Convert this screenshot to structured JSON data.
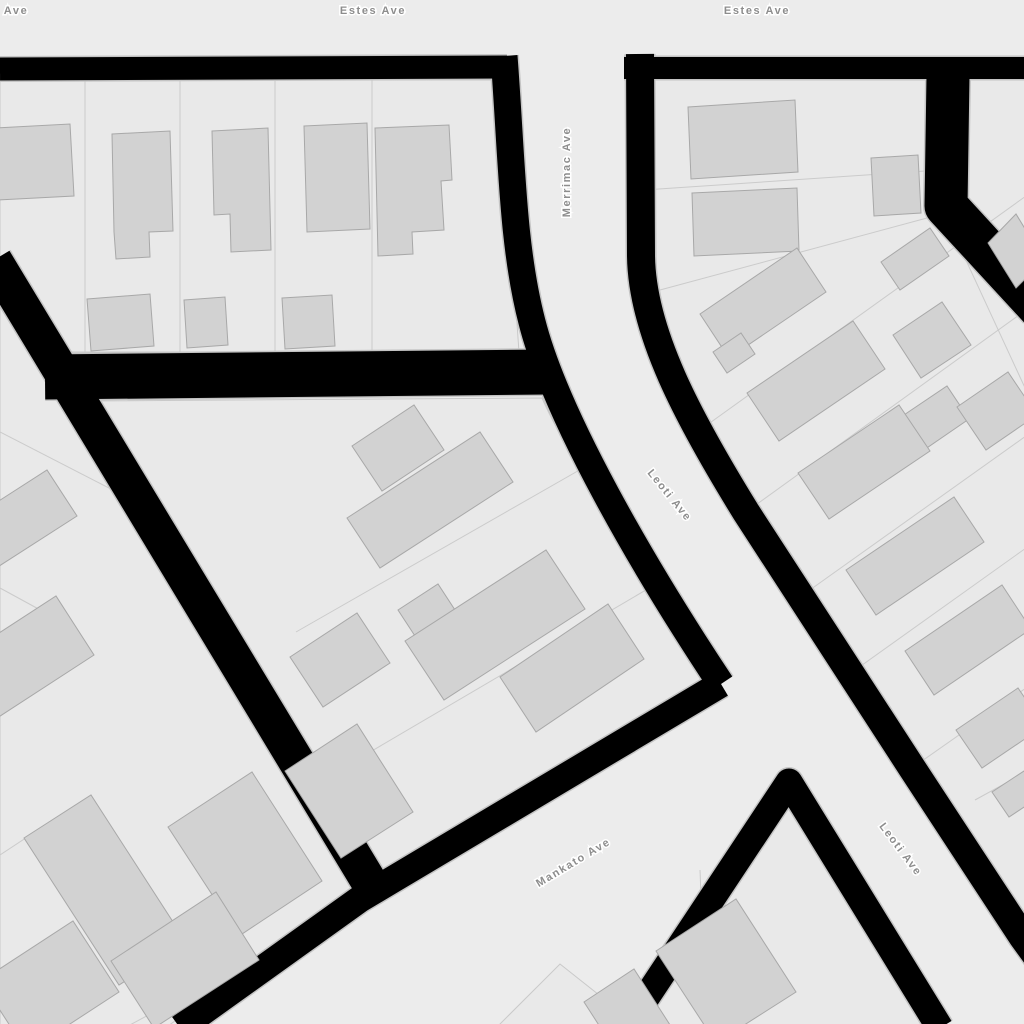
{
  "map": {
    "street_labels": [
      {
        "text": "Ave",
        "x": 16,
        "y": 10,
        "rotation": 0
      },
      {
        "text": "Estes Ave",
        "x": 373,
        "y": 10,
        "rotation": 0
      },
      {
        "text": "Estes Ave",
        "x": 757,
        "y": 10,
        "rotation": 0
      },
      {
        "text": "Merrimac Ave",
        "x": 566,
        "y": 172,
        "rotation": -90
      },
      {
        "text": "Leoti Ave",
        "x": 670,
        "y": 495,
        "rotation": 51
      },
      {
        "text": "Mankato Ave",
        "x": 573,
        "y": 862,
        "rotation": -31
      },
      {
        "text": "Leoti Ave",
        "x": 901,
        "y": 849,
        "rotation": 53
      }
    ],
    "palette": {
      "street": "#ececec",
      "block": "#e9e9e9",
      "block_outline": "#c9c9c9",
      "parcel_line": "#cbcbcb",
      "building": "#d2d2d2",
      "building_outline": "#a8a8a8",
      "road": "#000000",
      "road_casing": "#c4c4c4",
      "label_text": "#8d8d8d",
      "label_halo": "#ffffff"
    }
  }
}
